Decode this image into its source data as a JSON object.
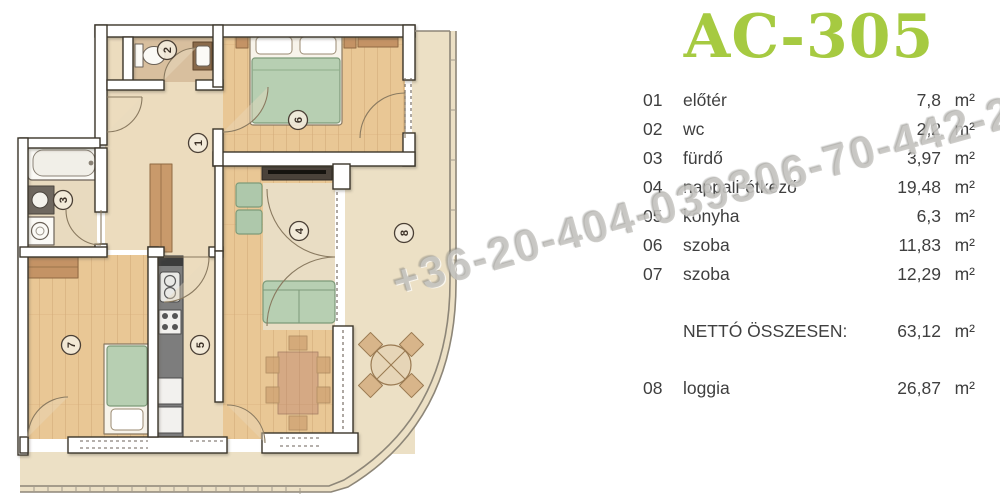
{
  "title": "AC-305",
  "accent_color": "#a6ca41",
  "watermark": "+36-20-404-039306-70-442-2",
  "legend": {
    "rows": [
      {
        "num": "01",
        "name": "előtér",
        "area": "7,8",
        "unit": "m²"
      },
      {
        "num": "02",
        "name": "wc",
        "area": "2,2",
        "unit": "m²"
      },
      {
        "num": "03",
        "name": "fürdő",
        "area": "3,97",
        "unit": "m²"
      },
      {
        "num": "04",
        "name": "nappali-étkező",
        "area": "19,48",
        "unit": "m²"
      },
      {
        "num": "05",
        "name": "konyha",
        "area": "6,3",
        "unit": "m²"
      },
      {
        "num": "06",
        "name": "szoba",
        "area": "11,83",
        "unit": "m²"
      },
      {
        "num": "07",
        "name": "szoba",
        "area": "12,29",
        "unit": "m²"
      }
    ],
    "total_label": "NETTÓ ÖSSZESEN:",
    "total_area": "63,12",
    "total_unit": "m²",
    "loggia_row": {
      "num": "08",
      "name": "loggia",
      "area": "26,87",
      "unit": "m²"
    }
  },
  "floorplan": {
    "markers": [
      {
        "room": "előtér",
        "num": "1"
      },
      {
        "room": "wc",
        "num": "2"
      },
      {
        "room": "fürdő",
        "num": "3"
      },
      {
        "room": "nappali-étkező",
        "num": "4"
      },
      {
        "room": "konyha",
        "num": "5"
      },
      {
        "room": "szoba-felső",
        "num": "6"
      },
      {
        "room": "szoba-bal",
        "num": "7"
      },
      {
        "room": "loggia",
        "num": "8"
      }
    ]
  }
}
